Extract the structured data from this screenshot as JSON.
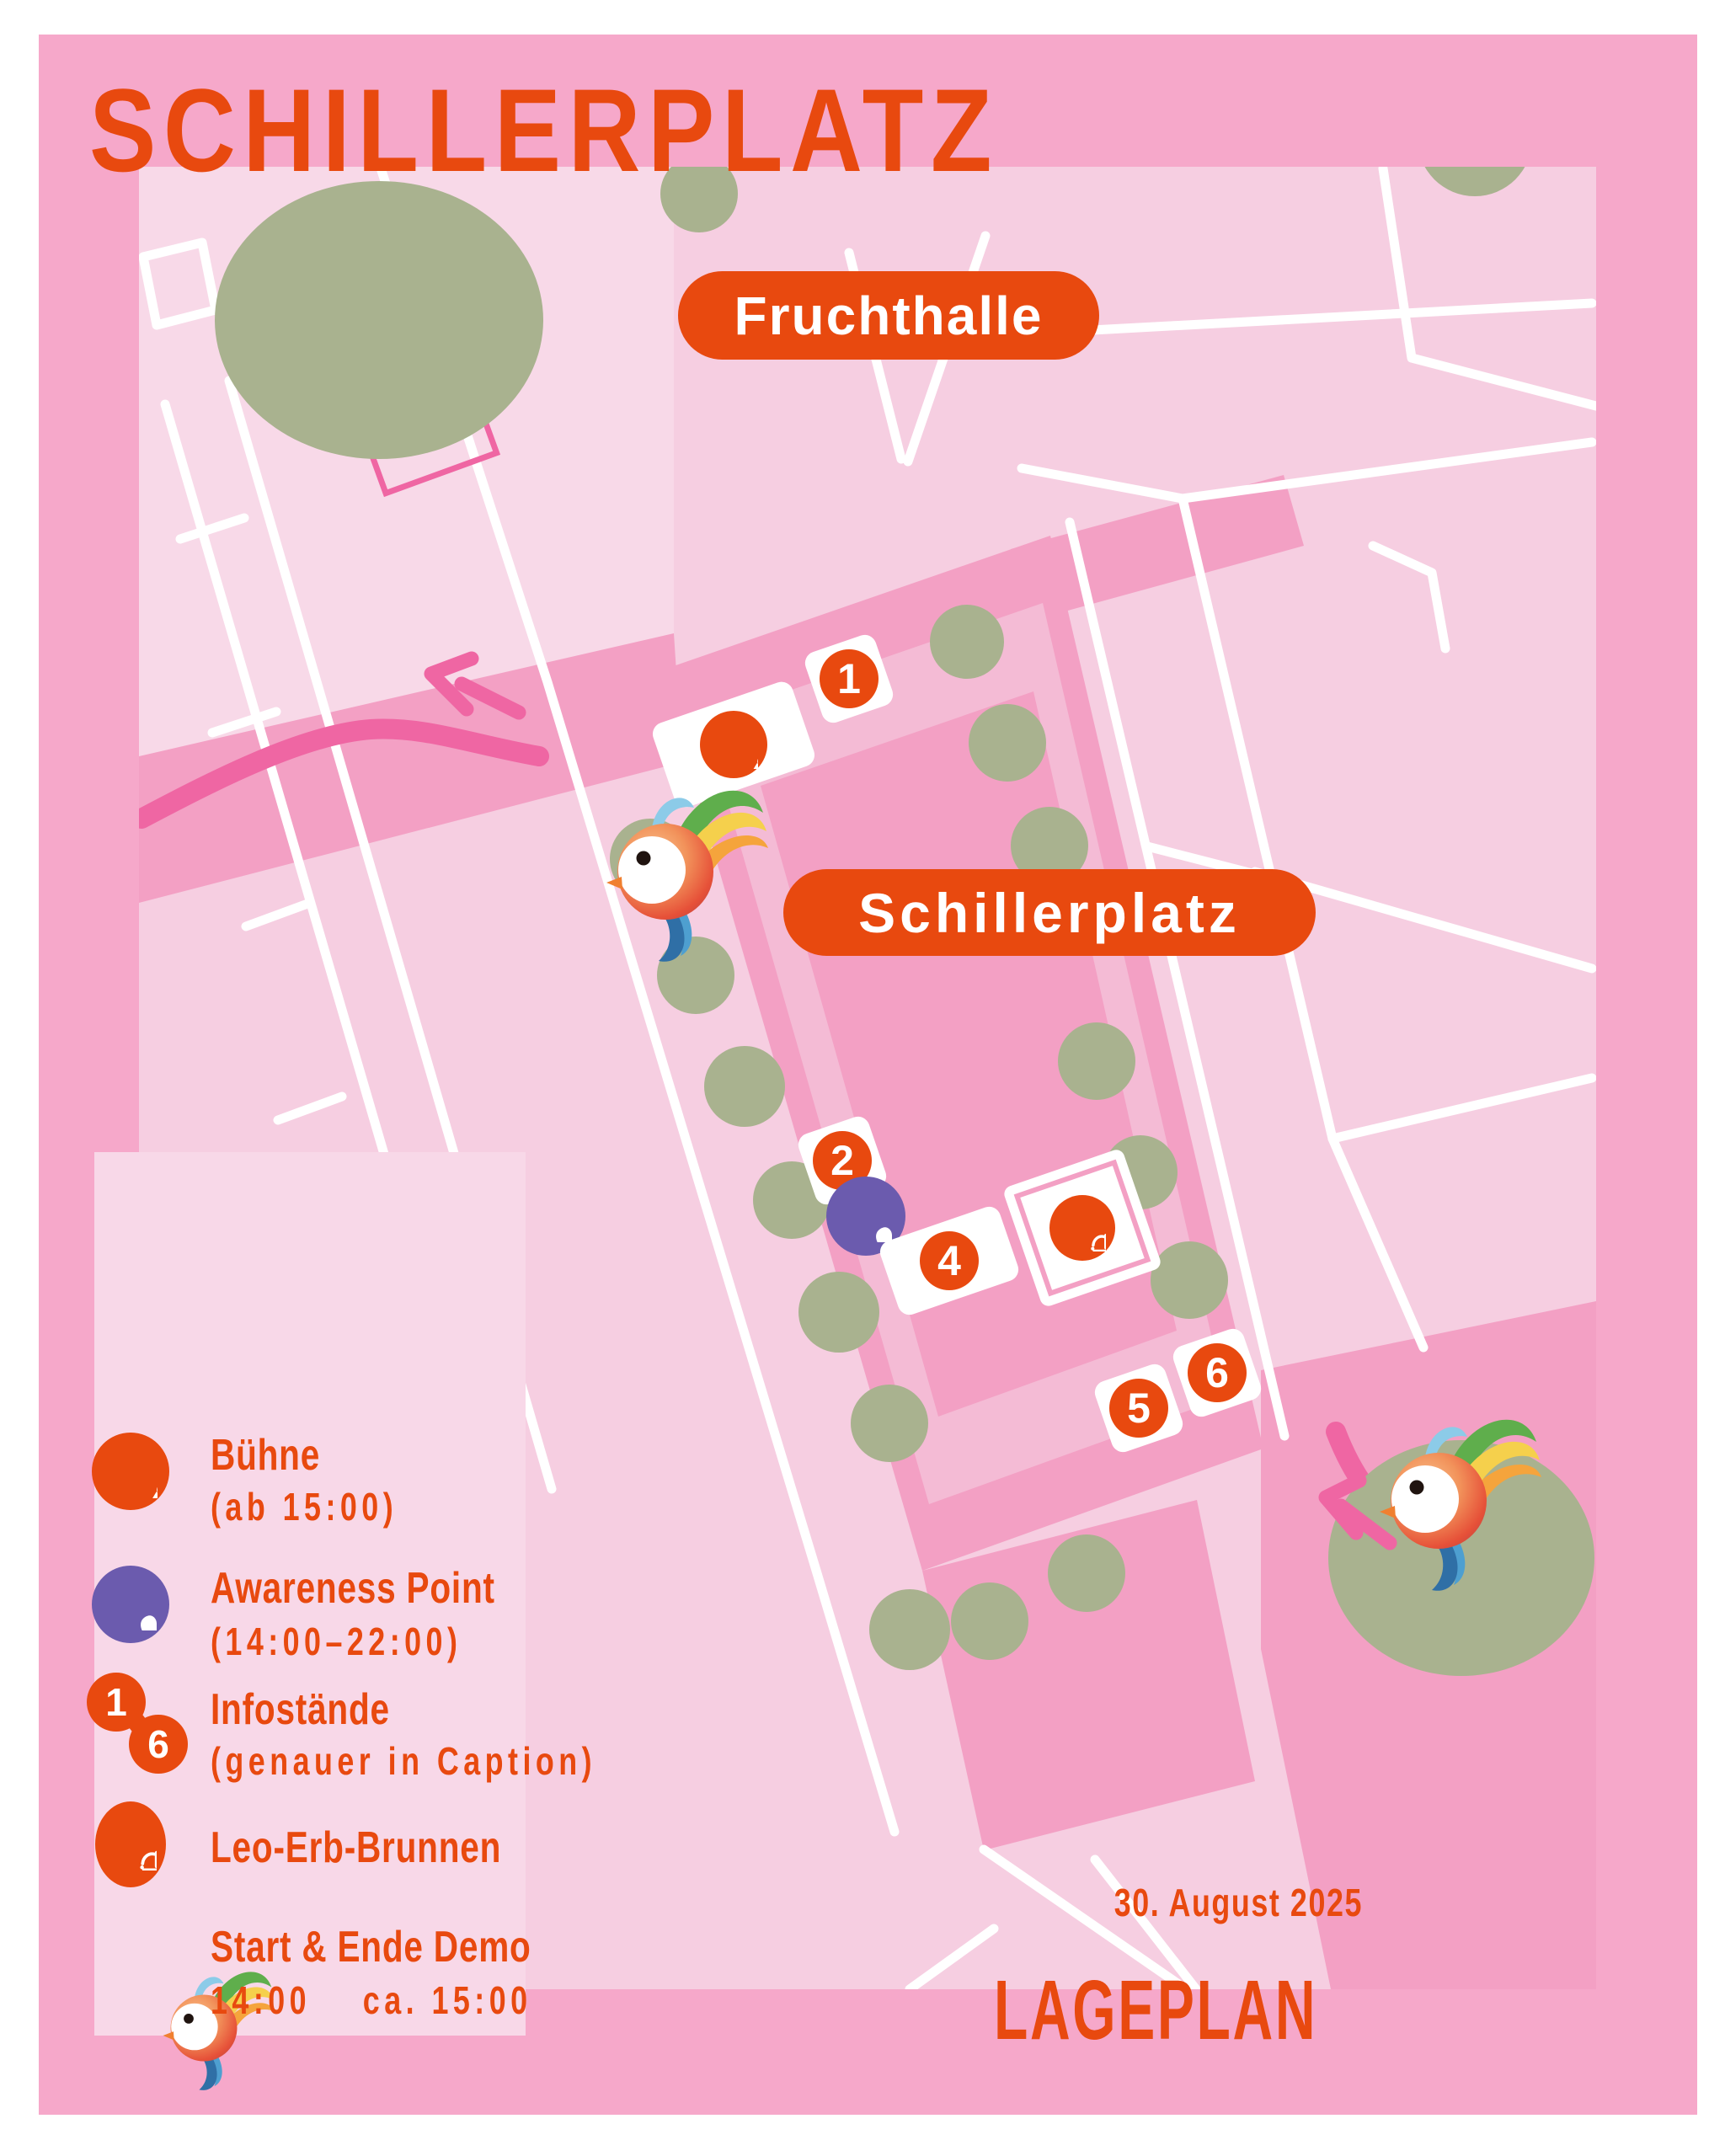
{
  "poster": {
    "title": "SCHILLERPLATZ",
    "date": "30. August 2025",
    "plan_label": "LAGEPLAN"
  },
  "map": {
    "area_labels": {
      "fruchthalle": "Fruchthalle",
      "schillerplatz": "Schillerplatz"
    },
    "markers": [
      {
        "label": "1"
      },
      {
        "label": "2"
      },
      {
        "label": "4"
      },
      {
        "label": "5"
      },
      {
        "label": "6"
      }
    ],
    "poi": {
      "stage_icon": "microphone-icon",
      "awareness_icon": "heart-icon",
      "fountain_icon": "fountain-icon",
      "demo_icon": "rainbow-bird-icon"
    }
  },
  "legend": {
    "items": [
      {
        "icon": "microphone-icon",
        "title": "Bühne",
        "subtitle": "(ab 15:00)"
      },
      {
        "icon": "heart-icon",
        "title": "Awareness Point",
        "subtitle": "(14:00–22:00)"
      },
      {
        "icon": "numbers-range-icon",
        "title": "Infostände",
        "subtitle": "(genauer in Caption)",
        "range_from": "1",
        "range_to": "6"
      },
      {
        "icon": "fountain-icon",
        "title": "Leo-Erb-Brunnen",
        "subtitle": ""
      },
      {
        "icon": "rainbow-bird-icon",
        "title": "Start & Ende Demo",
        "subtitle": "14:00    ca. 15:00"
      }
    ]
  },
  "colors": {
    "orange": "#E8490F",
    "purple": "#6B5BAE",
    "route_pink": "#EF66A3",
    "border_pink": "#F6A8CA",
    "platz_pink": "#F3A0C4",
    "block_pink": "#F6CEE1",
    "panel_pink": "#F8D8E8",
    "tree_green": "#A9B28F"
  }
}
